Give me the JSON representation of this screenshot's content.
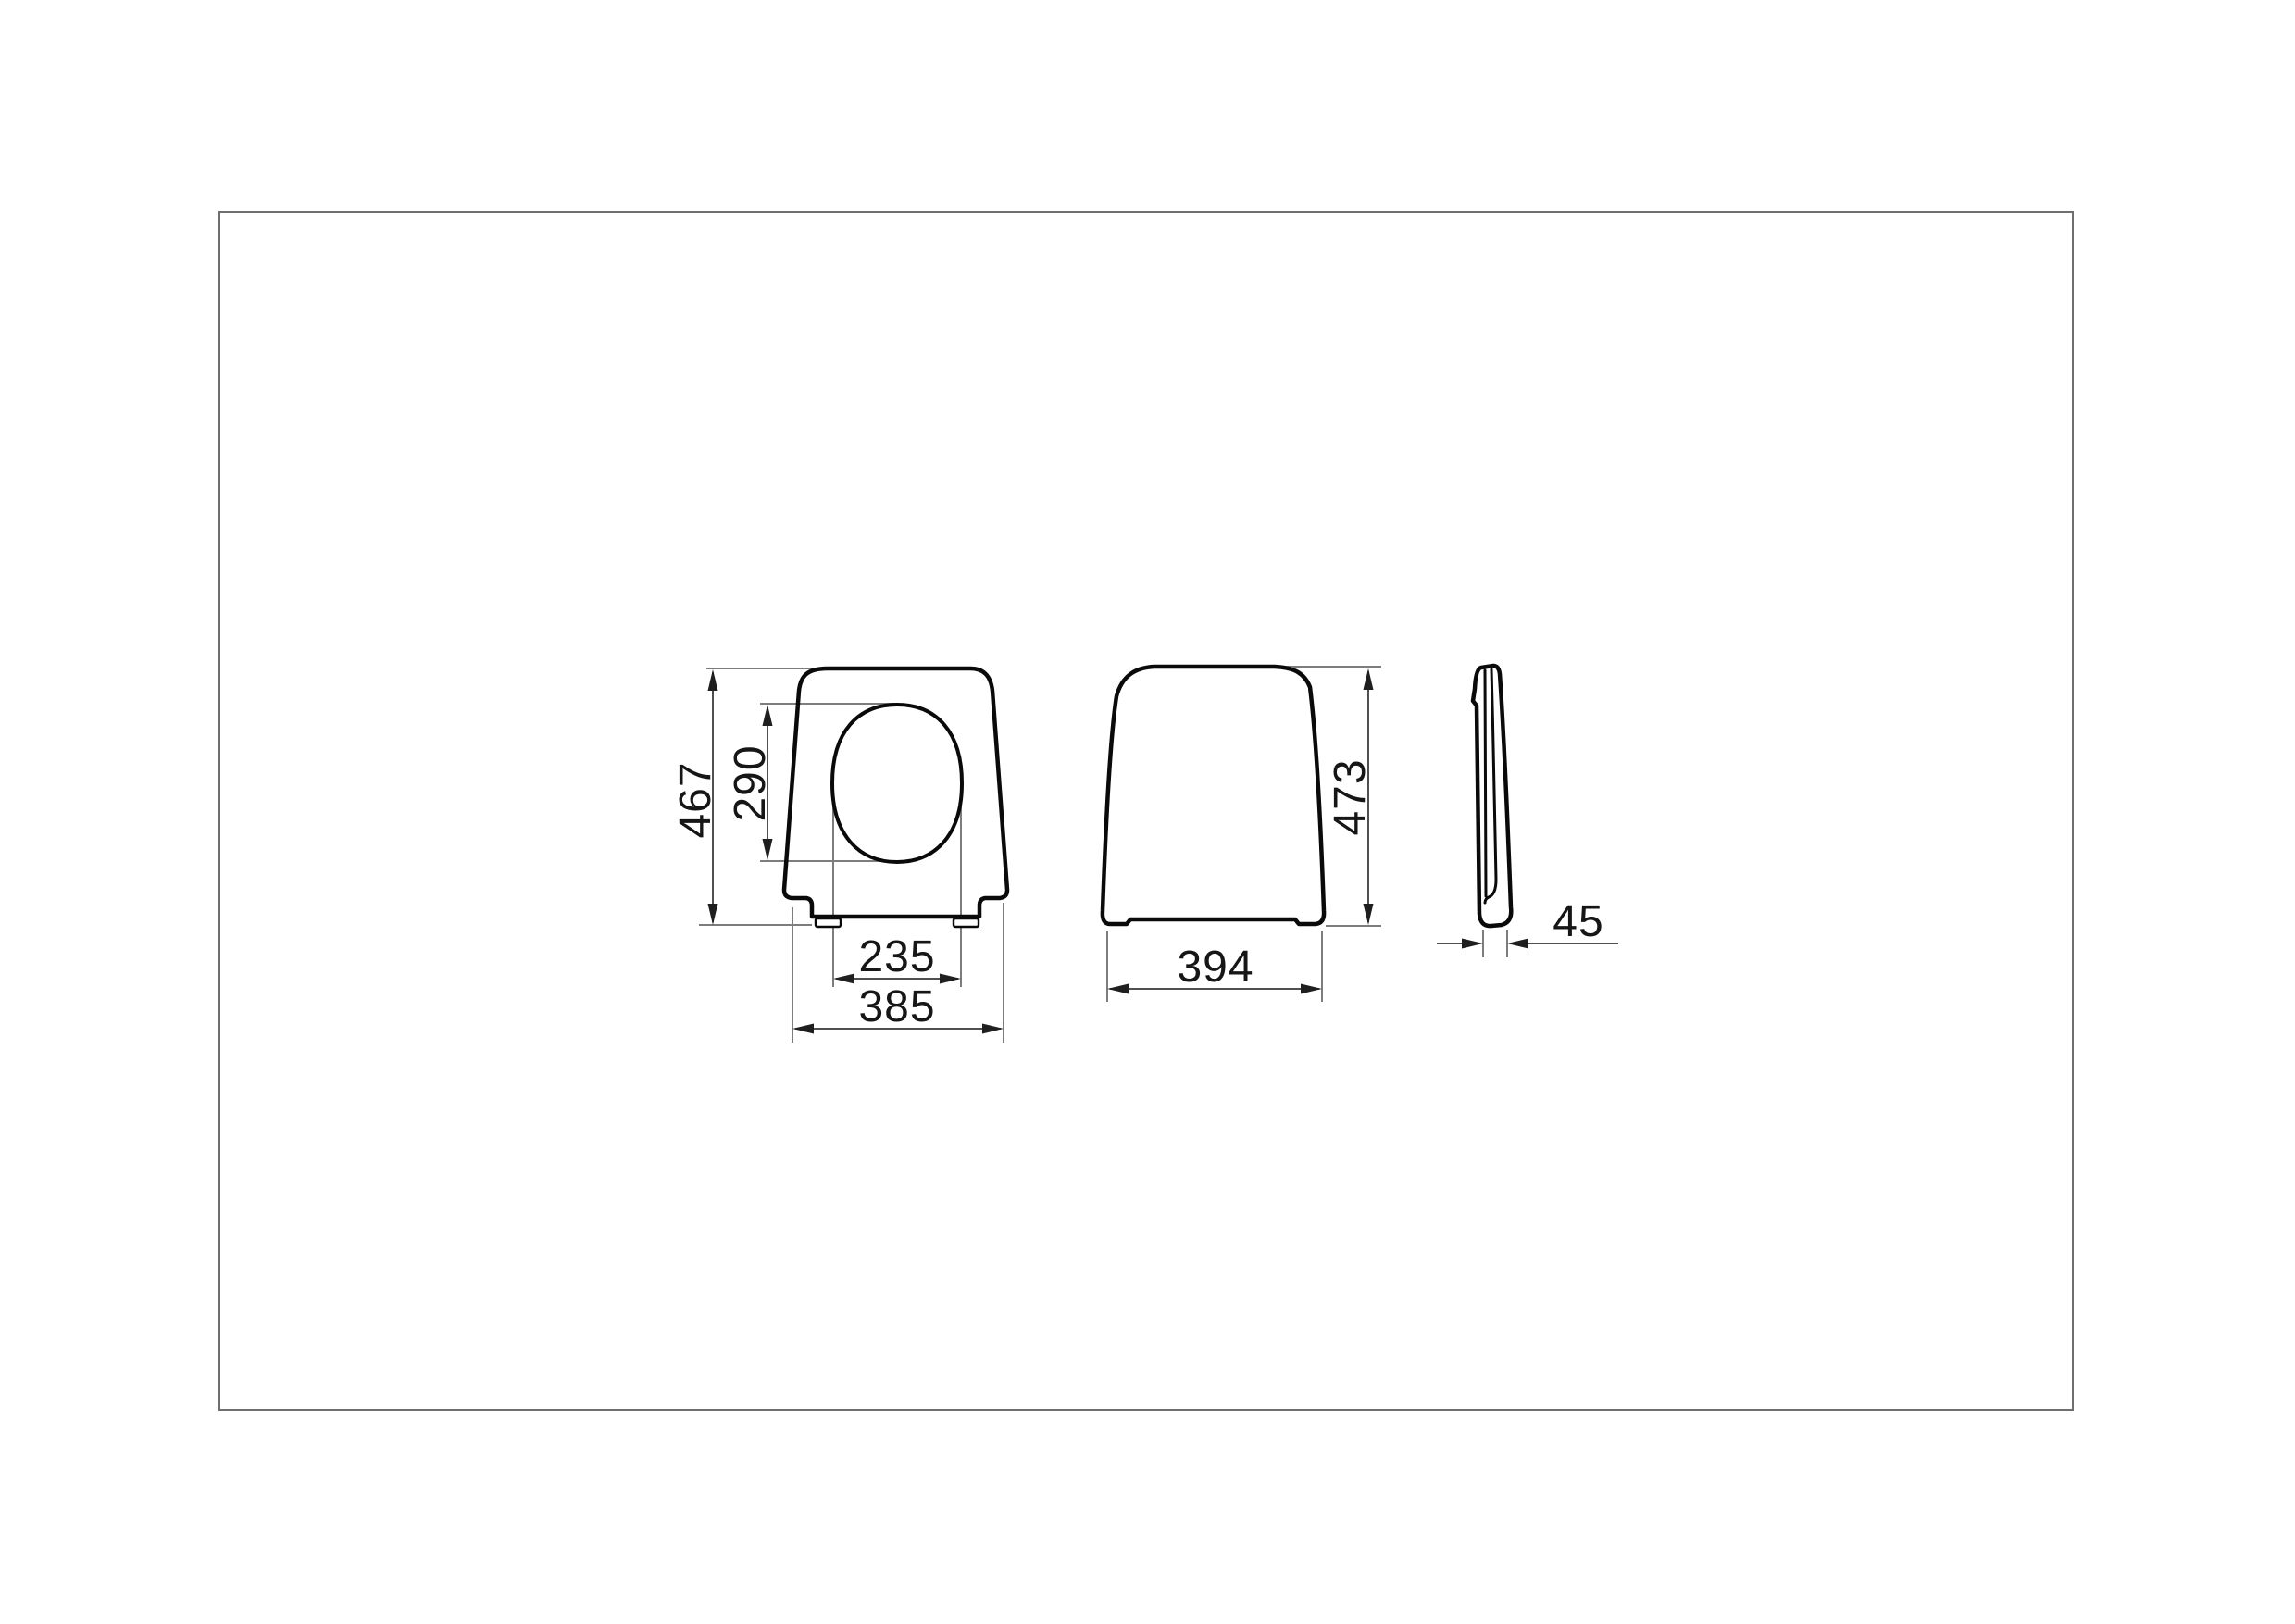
{
  "drawing": {
    "type": "technical-orthographic-views",
    "subject": "toilet seat cover",
    "frame": {
      "border_color": "#6f6f6f",
      "background": "#ffffff"
    },
    "colors": {
      "outline": "#0a0a0a",
      "dimension_line": "#4f4f4f",
      "extension_line": "#7d7d7d",
      "arrow": "#1f1f1f",
      "text": "#161616"
    },
    "dimensions": {
      "top_view_length": "467",
      "opening_length": "290",
      "opening_width": "235",
      "top_view_width": "385",
      "front_view_height": "473",
      "front_view_width": "394",
      "side_view_thickness": "45"
    }
  }
}
